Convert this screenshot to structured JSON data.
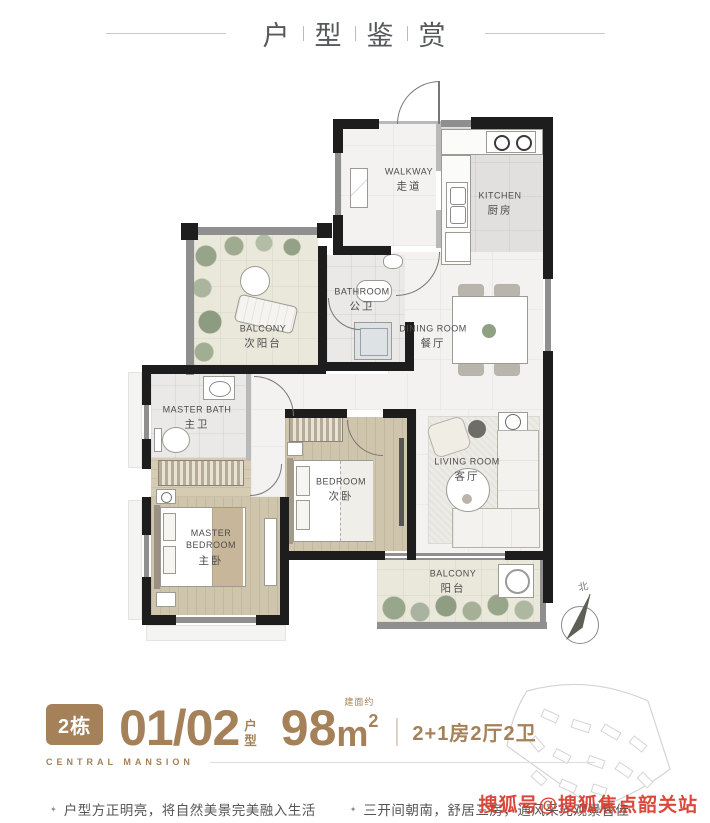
{
  "header": {
    "title_chars": [
      "户",
      "型",
      "鉴",
      "赏"
    ]
  },
  "floorplan": {
    "rooms": [
      {
        "id": "walkway",
        "en": "WALKWAY",
        "zh": "走道"
      },
      {
        "id": "kitchen",
        "en": "KITCHEN",
        "zh": "厨房"
      },
      {
        "id": "bathroom",
        "en": "BATHROOM",
        "zh": "公卫"
      },
      {
        "id": "balcony-north",
        "en": "BALCONY",
        "zh": "次阳台"
      },
      {
        "id": "dining-room",
        "en": "DINING ROOM",
        "zh": "餐厅"
      },
      {
        "id": "master-bath",
        "en": "MASTER BATH",
        "zh": "主卫"
      },
      {
        "id": "bedroom",
        "en": "BEDROOM",
        "zh": "次卧"
      },
      {
        "id": "living-room",
        "en": "LIVING ROOM",
        "zh": "客厅"
      },
      {
        "id": "master-bedroom",
        "en": "MASTER BEDROOM",
        "zh": "主卧"
      },
      {
        "id": "balcony-south",
        "en": "BALCONY",
        "zh": "阳台"
      }
    ],
    "compass_label": "北"
  },
  "info": {
    "building_badge": "2栋",
    "unit_number": "01/02",
    "unit_label_chars": [
      "户",
      "型"
    ],
    "area_number": "98",
    "area_unit": "m",
    "area_sup": "2",
    "area_note": "建面约",
    "layout_spec": "2+1房2厅2卫",
    "project_name": "CENTRAL MANSION"
  },
  "bullets": [
    {
      "marker": "✦",
      "text": "户型方正明亮，将自然美景完美融入生活"
    },
    {
      "marker": "✦",
      "text": "三开间朝南，舒居三房，通风采光观景皆佳"
    }
  ],
  "watermark": "搜狐号@搜狐焦点韶关站",
  "colors": {
    "accent_brown": "#a5815a",
    "watermark_red": "#d8392b",
    "wall_black": "#1d1d1d"
  }
}
